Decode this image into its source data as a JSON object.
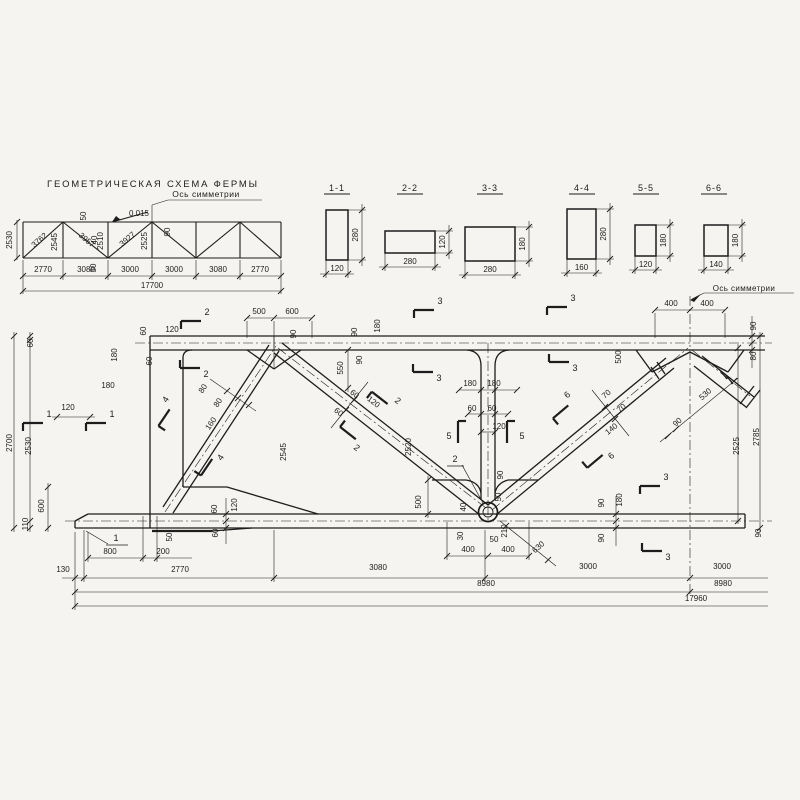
{
  "page": {
    "background": "#f5f4f0",
    "ink": "#1d1d1d"
  },
  "scheme": {
    "title": "ГЕОМЕТРИЧЕСКАЯ  СХЕМА  ФЕРМЫ",
    "symmetry_label": "Ось симметрии",
    "slope": "0.015",
    "left_height": "2530",
    "panel_widths": [
      "2770",
      "3080",
      "3000",
      "3000",
      "3080",
      "2770"
    ],
    "total_span": "17700",
    "member_lengths": {
      "diagonals": [
        "3762",
        "3957",
        "3927"
      ],
      "verticals": [
        "2545",
        "2510",
        "2525"
      ]
    },
    "node_offsets": [
      "50",
      "40",
      "30",
      "90"
    ],
    "labels": [
      {
        "t": "2530",
        "x": 12,
        "y": 240,
        "r": -90
      },
      {
        "t": "3762",
        "x": 41,
        "y": 242,
        "r": -41
      },
      {
        "t": "2545",
        "x": 57,
        "y": 242,
        "r": -90
      },
      {
        "t": "3957",
        "x": 85,
        "y": 242,
        "r": 41
      },
      {
        "t": "2510",
        "x": 103,
        "y": 241,
        "r": -90
      },
      {
        "t": "3927",
        "x": 129,
        "y": 241,
        "r": -41
      },
      {
        "t": "2525",
        "x": 147,
        "y": 241,
        "r": -90
      },
      {
        "t": "50",
        "x": 86,
        "y": 216,
        "r": -90
      },
      {
        "t": "0.015",
        "x": 139,
        "y": 216
      },
      {
        "t": "40",
        "x": 97,
        "y": 240,
        "r": -90
      },
      {
        "t": "30",
        "x": 96,
        "y": 268,
        "r": -90
      },
      {
        "t": "90",
        "x": 170,
        "y": 232,
        "r": -90
      },
      {
        "t": "2770",
        "x": 43,
        "y": 272
      },
      {
        "t": "3080",
        "x": 86,
        "y": 272
      },
      {
        "t": "3000",
        "x": 130,
        "y": 272
      },
      {
        "t": "3000",
        "x": 174,
        "y": 272
      },
      {
        "t": "3080",
        "x": 218,
        "y": 272
      },
      {
        "t": "2770",
        "x": 260,
        "y": 272
      },
      {
        "t": "17700",
        "x": 152,
        "y": 288
      }
    ]
  },
  "sections": {
    "items": [
      {
        "label": "1-1",
        "width": "120",
        "height": "280"
      },
      {
        "label": "2-2",
        "width": "280",
        "height": "120"
      },
      {
        "label": "3-3",
        "width": "280",
        "height": "180"
      },
      {
        "label": "4-4",
        "width": "160",
        "height": "280"
      },
      {
        "label": "5-5",
        "width": "120",
        "height": "180"
      },
      {
        "label": "6-6",
        "width": "140",
        "height": "180"
      }
    ]
  },
  "elevation": {
    "symmetry_label": "Ось симметрии",
    "overall_length": "17960",
    "half_length": "8980",
    "overall_height": "2700",
    "bottom_panels": [
      "130",
      "2770",
      "3080",
      "3000",
      "3000"
    ],
    "labels": [
      {
        "t": "60",
        "x": 146,
        "y": 331,
        "r": -90
      },
      {
        "t": "60",
        "x": 152,
        "y": 361,
        "r": -90
      },
      {
        "t": "120",
        "x": 172,
        "y": 332
      },
      {
        "t": "180",
        "x": 117,
        "y": 355,
        "r": -90
      },
      {
        "t": "180",
        "x": 108,
        "y": 388
      },
      {
        "t": "120",
        "x": 68,
        "y": 410
      },
      {
        "t": "60",
        "x": 33,
        "y": 343,
        "r": -90
      },
      {
        "t": "2530",
        "x": 31,
        "y": 446,
        "r": -90
      },
      {
        "t": "600",
        "x": 44,
        "y": 506,
        "r": -90
      },
      {
        "t": "110",
        "x": 28,
        "y": 524,
        "r": -90
      },
      {
        "t": "2700",
        "x": 12,
        "y": 443,
        "r": -90
      },
      {
        "t": "500",
        "x": 259,
        "y": 314
      },
      {
        "t": "600",
        "x": 292,
        "y": 314
      },
      {
        "t": "90",
        "x": 296,
        "y": 334,
        "r": -90
      },
      {
        "t": "90",
        "x": 357,
        "y": 332,
        "r": -90
      },
      {
        "t": "180",
        "x": 380,
        "y": 326,
        "r": -90
      },
      {
        "t": "550",
        "x": 343,
        "y": 368,
        "r": -90
      },
      {
        "t": "90",
        "x": 362,
        "y": 360,
        "r": -90
      },
      {
        "t": "2545",
        "x": 286,
        "y": 452,
        "r": -90
      },
      {
        "t": "2520",
        "x": 411,
        "y": 447,
        "r": -90
      },
      {
        "t": "80",
        "x": 205,
        "y": 390,
        "r": -56
      },
      {
        "t": "80",
        "x": 220,
        "y": 404,
        "r": -56
      },
      {
        "t": "160",
        "x": 213,
        "y": 425,
        "r": -56
      },
      {
        "t": "60",
        "x": 353,
        "y": 396,
        "r": 38
      },
      {
        "t": "60",
        "x": 337,
        "y": 414,
        "r": 38
      },
      {
        "t": "120",
        "x": 372,
        "y": 404,
        "r": 38
      },
      {
        "t": "180",
        "x": 470,
        "y": 386
      },
      {
        "t": "180",
        "x": 494,
        "y": 386
      },
      {
        "t": "60",
        "x": 472,
        "y": 411
      },
      {
        "t": "60",
        "x": 492,
        "y": 411
      },
      {
        "t": "120",
        "x": 499,
        "y": 429
      },
      {
        "t": "90",
        "x": 503,
        "y": 475,
        "r": -90
      },
      {
        "t": "50",
        "x": 501,
        "y": 497,
        "r": -90
      },
      {
        "t": "500",
        "x": 421,
        "y": 502,
        "r": -90
      },
      {
        "t": "40",
        "x": 466,
        "y": 507,
        "r": -90
      },
      {
        "t": "30",
        "x": 463,
        "y": 536,
        "r": -90
      },
      {
        "t": "50",
        "x": 494,
        "y": 542
      },
      {
        "t": "210",
        "x": 507,
        "y": 531,
        "r": -90
      },
      {
        "t": "400",
        "x": 468,
        "y": 552
      },
      {
        "t": "400",
        "x": 508,
        "y": 552
      },
      {
        "t": "630",
        "x": 540,
        "y": 549,
        "r": -42
      },
      {
        "t": "800",
        "x": 110,
        "y": 554
      },
      {
        "t": "200",
        "x": 163,
        "y": 554
      },
      {
        "t": "50",
        "x": 172,
        "y": 537,
        "r": -90
      },
      {
        "t": "60",
        "x": 217,
        "y": 509,
        "r": -90
      },
      {
        "t": "60",
        "x": 218,
        "y": 533,
        "r": -90
      },
      {
        "t": "120",
        "x": 237,
        "y": 505,
        "r": -90
      },
      {
        "t": "90",
        "x": 604,
        "y": 503,
        "r": -90
      },
      {
        "t": "180",
        "x": 622,
        "y": 500,
        "r": -90
      },
      {
        "t": "90",
        "x": 604,
        "y": 538,
        "r": -90
      },
      {
        "t": "90",
        "x": 761,
        "y": 533,
        "r": -90
      },
      {
        "t": "70",
        "x": 608,
        "y": 396,
        "r": -40
      },
      {
        "t": "70",
        "x": 623,
        "y": 410,
        "r": -40
      },
      {
        "t": "140",
        "x": 613,
        "y": 431,
        "r": -40
      },
      {
        "t": "500",
        "x": 621,
        "y": 357,
        "r": -90
      },
      {
        "t": "90",
        "x": 679,
        "y": 424,
        "r": -42
      },
      {
        "t": "530",
        "x": 707,
        "y": 396,
        "r": -42
      },
      {
        "t": "400",
        "x": 671,
        "y": 306
      },
      {
        "t": "400",
        "x": 707,
        "y": 306
      },
      {
        "t": "90",
        "x": 756,
        "y": 326,
        "r": -90
      },
      {
        "t": "80",
        "x": 756,
        "y": 356,
        "r": -90
      },
      {
        "t": "2525",
        "x": 739,
        "y": 446,
        "r": -90
      },
      {
        "t": "2785",
        "x": 759,
        "y": 437,
        "r": -90
      },
      {
        "t": "130",
        "x": 63,
        "y": 572
      },
      {
        "t": "2770",
        "x": 180,
        "y": 572
      },
      {
        "t": "3080",
        "x": 378,
        "y": 570
      },
      {
        "t": "3000",
        "x": 588,
        "y": 569
      },
      {
        "t": "3000",
        "x": 722,
        "y": 569
      },
      {
        "t": "8980",
        "x": 486,
        "y": 586
      },
      {
        "t": "8980",
        "x": 723,
        "y": 586
      },
      {
        "t": "17960",
        "x": 696,
        "y": 601
      }
    ],
    "section_flags": [
      {
        "t": "2",
        "x": 207,
        "y": 315,
        "v": "a"
      },
      {
        "t": "2",
        "x": 206,
        "y": 377,
        "v": "b"
      },
      {
        "t": "1",
        "x": 49,
        "y": 417,
        "v": "a"
      },
      {
        "t": "1",
        "x": 112,
        "y": 417,
        "v": "a"
      },
      {
        "t": "4",
        "x": 168,
        "y": 401,
        "r": -56,
        "v": "a"
      },
      {
        "t": "4",
        "x": 223,
        "y": 459,
        "r": -56,
        "v": "b"
      },
      {
        "t": "2",
        "x": 396,
        "y": 403,
        "r": 38,
        "v": "a"
      },
      {
        "t": "2",
        "x": 355,
        "y": 450,
        "r": 38,
        "v": "b"
      },
      {
        "t": "3",
        "x": 440,
        "y": 304,
        "v": "a"
      },
      {
        "t": "3",
        "x": 439,
        "y": 381,
        "v": "b"
      },
      {
        "t": "3",
        "x": 573,
        "y": 301,
        "v": "a"
      },
      {
        "t": "3",
        "x": 575,
        "y": 371,
        "v": "b"
      },
      {
        "t": "5",
        "x": 449,
        "y": 439,
        "v": "c"
      },
      {
        "t": "5",
        "x": 522,
        "y": 439,
        "v": "d"
      },
      {
        "t": "6",
        "x": 569,
        "y": 397,
        "r": -40,
        "v": "a"
      },
      {
        "t": "6",
        "x": 613,
        "y": 458,
        "r": -40,
        "v": "b"
      },
      {
        "t": "3",
        "x": 666,
        "y": 480,
        "v": "a"
      },
      {
        "t": "3",
        "x": 668,
        "y": 560,
        "v": "b"
      }
    ],
    "detail_leaders": [
      {
        "t": "1",
        "x": 116,
        "y": 541
      },
      {
        "t": "2",
        "x": 455,
        "y": 462
      }
    ]
  }
}
